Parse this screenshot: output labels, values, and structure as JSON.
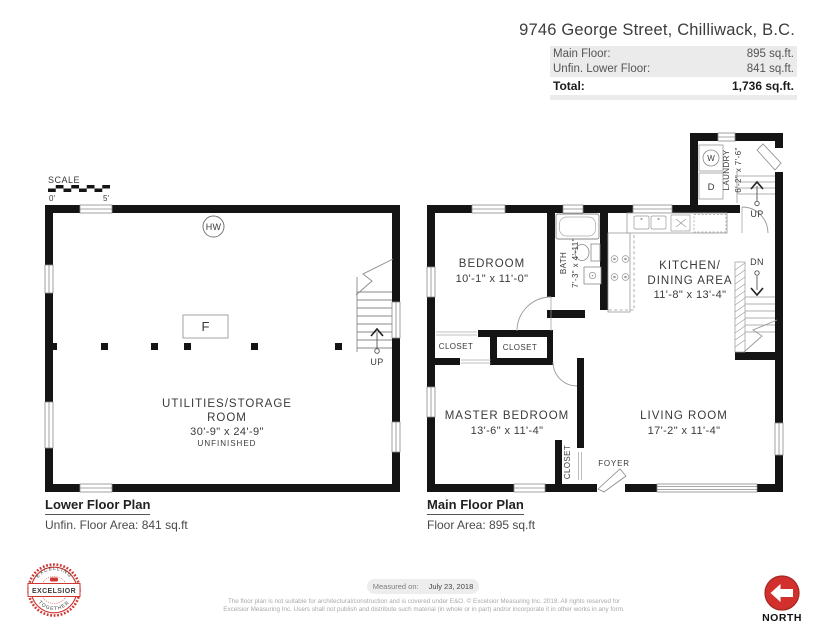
{
  "colors": {
    "wall": "#141414",
    "accent_red": "#d2302c",
    "panel_gray": "#ebebeb",
    "line_gray": "#999999"
  },
  "header": {
    "title": "9746 George Street, Chilliwack, B.C.",
    "rows": [
      {
        "label": "Main Floor:",
        "value": "895 sq.ft."
      },
      {
        "label": "Unfin. Lower Floor:",
        "value": "841 sq.ft."
      }
    ],
    "total_label": "Total:",
    "total_value": "1,736 sq.ft."
  },
  "lower_plan": {
    "scale_label": "SCALE",
    "scale_start": "0'",
    "scale_end": "5'",
    "hw": "HW",
    "furnace": "F",
    "up": "UP",
    "room_line1": "UTILITIES/STORAGE",
    "room_line2": "ROOM",
    "room_dims": "30'-9\" x 24'-9\"",
    "room_note": "UNFINISHED",
    "title": "Lower Floor Plan",
    "subtitle": "Unfin. Floor Area: 841 sq.ft"
  },
  "main_plan": {
    "title": "Main Floor Plan",
    "subtitle": "Floor Area: 895 sq.ft",
    "bedroom_name": "BEDROOM",
    "bedroom_dims": "10'-1\" x 11'-0\"",
    "bath_name": "BATH",
    "bath_dims": "7'-3\" x 4'-11\"",
    "kitchen_name1": "KITCHEN/",
    "kitchen_name2": "DINING AREA",
    "kitchen_dims": "11'-8\" x 13'-4\"",
    "laundry_name": "LAUNDRY",
    "laundry_dims": "6'-2\" x 7'-6\"",
    "washer": "W",
    "dryer": "D",
    "master_name": "MASTER BEDROOM",
    "master_dims": "13'-6\" x 11'-4\"",
    "living_name": "LIVING ROOM",
    "living_dims": "17'-2\" x 11'-4\"",
    "closet1": "CLOSET",
    "closet2": "CLOSET",
    "closet3": "CLOSET",
    "foyer": "FOYER",
    "up": "UP",
    "dn": "DN"
  },
  "footer": {
    "badge_top": "EXCELLING",
    "badge_center": "EXCELSIOR",
    "badge_bottom": "TOGETHER",
    "measured_label": "Measured on:",
    "measured_value": "July 23, 2018",
    "disclaimer1": "The floor plan is not suitable for architectural/construction and is covered under E&O. © Excelsior Measuring Inc. 2018. All rights reserved for",
    "disclaimer2": "Excelsior Measuring Inc. Users shall not publish and distribute such material (in whole or in part) and/or incorporate it in other works in any form.",
    "north": "NORTH"
  }
}
